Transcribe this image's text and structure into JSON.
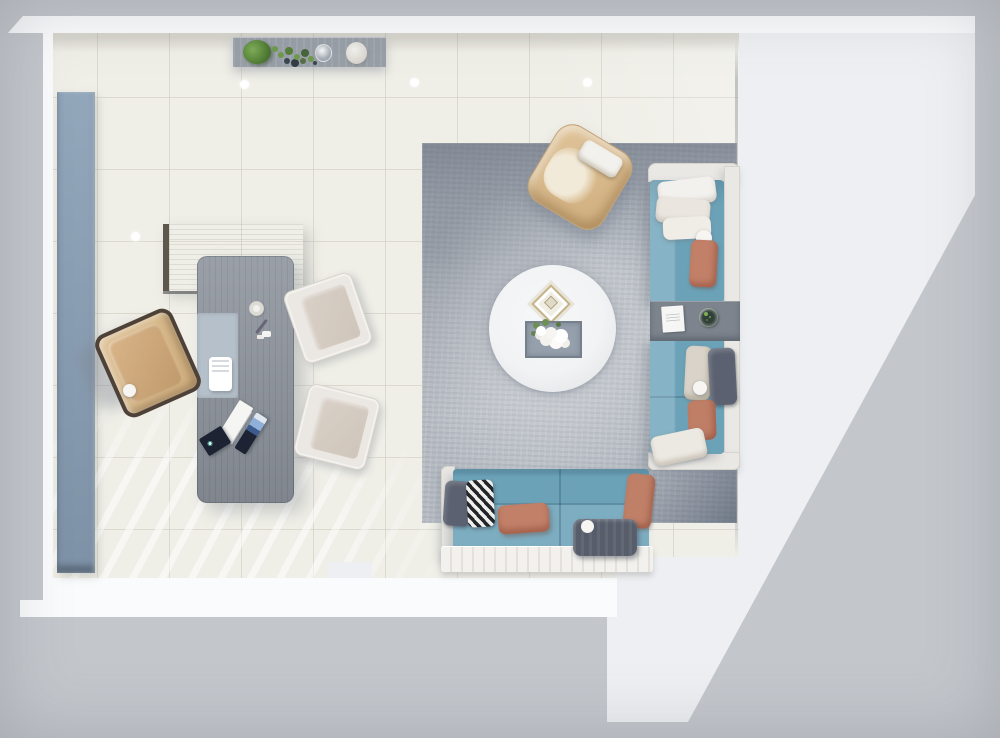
{
  "scene": {
    "type": "3d-floorplan-top-view-render",
    "view": "top-down",
    "room": "open-plan office and lounge",
    "visible_text": "none",
    "areas": [
      "workspace",
      "lounge"
    ]
  },
  "palette": {
    "bg": "#c3c7cc",
    "outer-white": "#edeff2",
    "wall-white": "#fafbfc",
    "floor": "#efeee7",
    "cabinet-blue-1": "#93a7bb",
    "cabinet-blue-2": "#7e92a7",
    "console-gray": "#989fa7",
    "desk-wood": "#8f959e",
    "desk-wood-dark": "#7c838c",
    "desk-edge": "#5f574e",
    "desk-pad": "#b5c0ca",
    "laptop-navy": "#1d2332",
    "screen-blue": "#8fb0d8",
    "chair-tan-1": "#e0c49a",
    "chair-tan-2": "#cfae7d",
    "chair-frame-dark": "#4e4238",
    "guest-frame": "#ebe8e3",
    "guest-seat": "#d9d0c7",
    "rug-base": "#b7bcc3",
    "marble": "#f2f3f4",
    "gold": "#c5b488",
    "sofa-teal": "#6ba2b8",
    "sofa-frame": "#eae8e4",
    "pillow-white": "#f3f1ed",
    "pillow-beige": "#d9d3c9",
    "pillow-coral": "#c28069",
    "pillow-dark": "#5b6170",
    "ottoman-gray": "#575d6b",
    "table-gray": "#7d848d",
    "stripe-dark": "#22262b",
    "plant-green": "#5e8f3f"
  },
  "objects": [
    {
      "name": "sideboard-cabinet",
      "desc": "blue-gray low cabinet along left wall"
    },
    {
      "name": "console-table",
      "desc": "gray console with plants, glass and vase"
    },
    {
      "name": "desk-return-cabinet",
      "desc": "gray wood return unit"
    },
    {
      "name": "office-desk",
      "desc": "gray wood desk with pad, phone, laptop, papers"
    },
    {
      "name": "office-chair",
      "desc": "tan leather task chair"
    },
    {
      "name": "guest-chair",
      "desc": "two cream guest chairs"
    },
    {
      "name": "area-rug",
      "desc": "large mottled gray rug"
    },
    {
      "name": "coffee-table",
      "desc": "round white marble table with tray of flowers"
    },
    {
      "name": "lounge-armchair",
      "desc": "tan swivel armchair with white pillow"
    },
    {
      "name": "sofa-right",
      "desc": "teal chaise sections with white frame and pillows"
    },
    {
      "name": "sofa-bottom",
      "desc": "teal sofa with striped, coral and gray pillows"
    },
    {
      "name": "side-table",
      "desc": "gray slab table between sofa sections"
    },
    {
      "name": "ottoman",
      "desc": "dark gray bolster cushion"
    },
    {
      "name": "ceiling-light",
      "desc": "five recessed light dots on floor"
    }
  ]
}
